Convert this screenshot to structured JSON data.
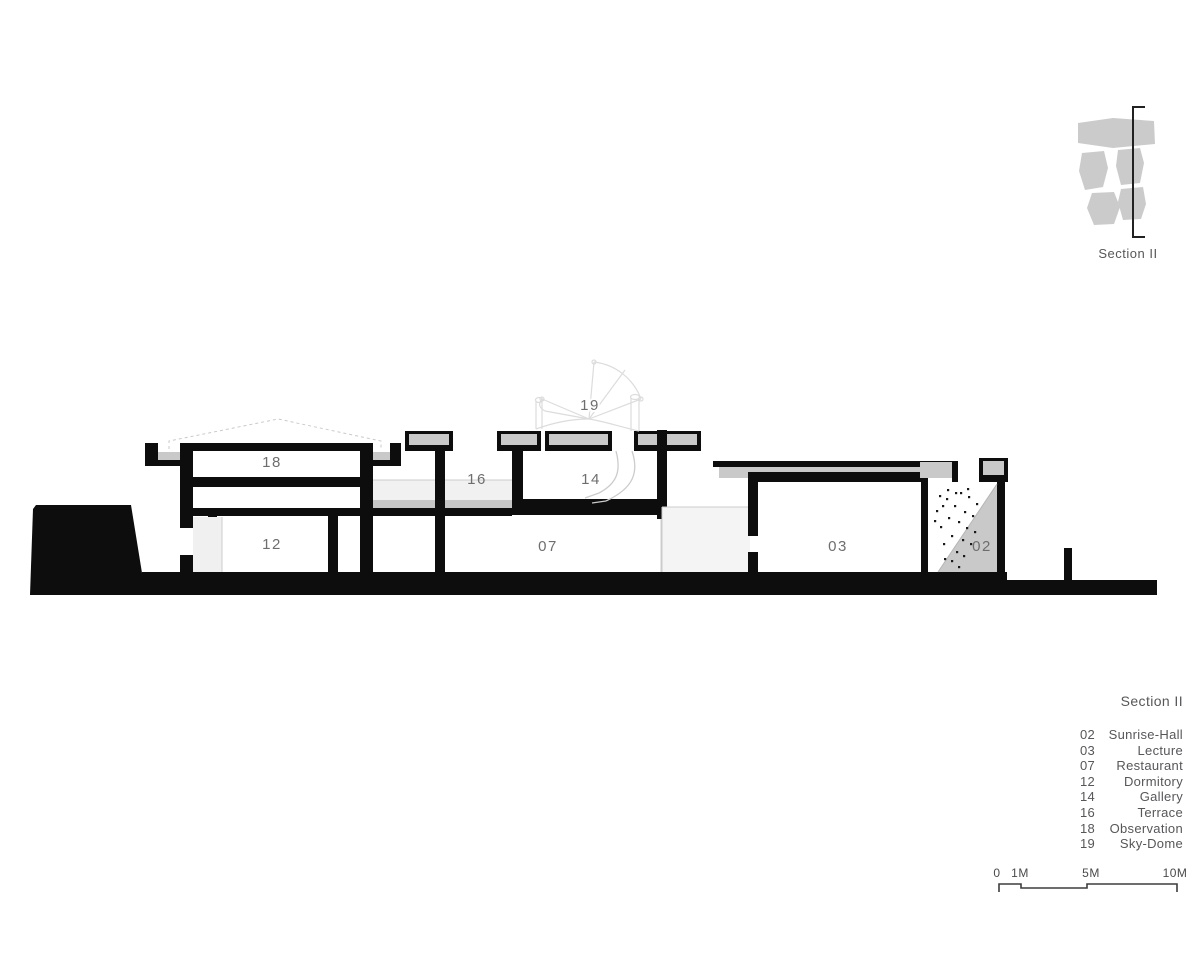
{
  "key_plan": {
    "caption": "Section II"
  },
  "drawing": {
    "labels": [
      {
        "room": "observation",
        "text": "18"
      },
      {
        "room": "dormitory",
        "text": "12"
      },
      {
        "room": "terrace",
        "text": "16"
      },
      {
        "room": "gallery",
        "text": "14"
      },
      {
        "room": "sky-dome",
        "text": "19"
      },
      {
        "room": "restaurant",
        "text": "07"
      },
      {
        "room": "lecture",
        "text": "03"
      },
      {
        "room": "sunrise-hall",
        "text": "02"
      }
    ]
  },
  "legend": {
    "title": "Section II",
    "rows": [
      {
        "num": "02",
        "name": "Sunrise-Hall"
      },
      {
        "num": "03",
        "name": "Lecture"
      },
      {
        "num": "07",
        "name": "Restaurant"
      },
      {
        "num": "12",
        "name": "Dormitory"
      },
      {
        "num": "14",
        "name": "Gallery"
      },
      {
        "num": "16",
        "name": "Terrace"
      },
      {
        "num": "18",
        "name": "Observation"
      },
      {
        "num": "19",
        "name": "Sky-Dome"
      }
    ]
  },
  "scale_bar": {
    "ticks": [
      "0",
      "1M",
      "5M",
      "10M"
    ]
  },
  "colors": {
    "ink": "#0d0d0d",
    "panel_gray": "#c9c9c9",
    "deck_light": "#f1f1f1",
    "court_light": "#f4f4f4",
    "line_gray": "#cccccc",
    "dome_gray": "#dcdcdc",
    "text_gray": "#57575a",
    "label_gray": "#6e6e6e"
  }
}
